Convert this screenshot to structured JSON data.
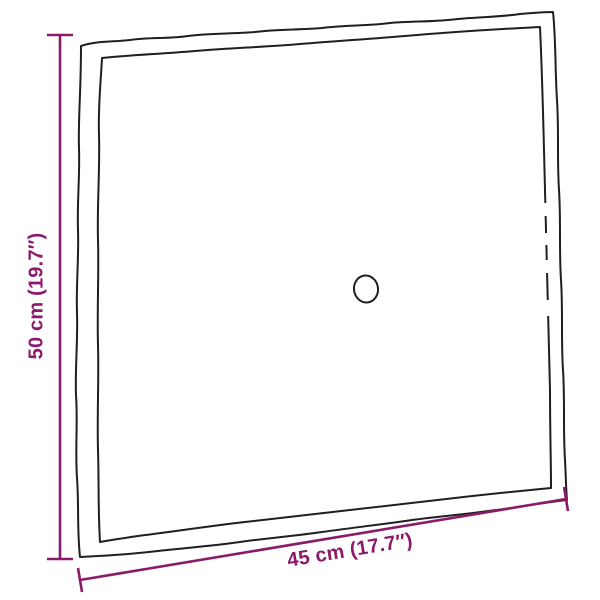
{
  "diagram": {
    "dimensions": {
      "height_label": "50 cm (19.7″)",
      "width_label": "45 cm (17.7″)"
    },
    "colors": {
      "dimension_accent": "#8C1A6B",
      "outline_ink": "#1F1F1F",
      "background": "#FFFFFF"
    }
  }
}
